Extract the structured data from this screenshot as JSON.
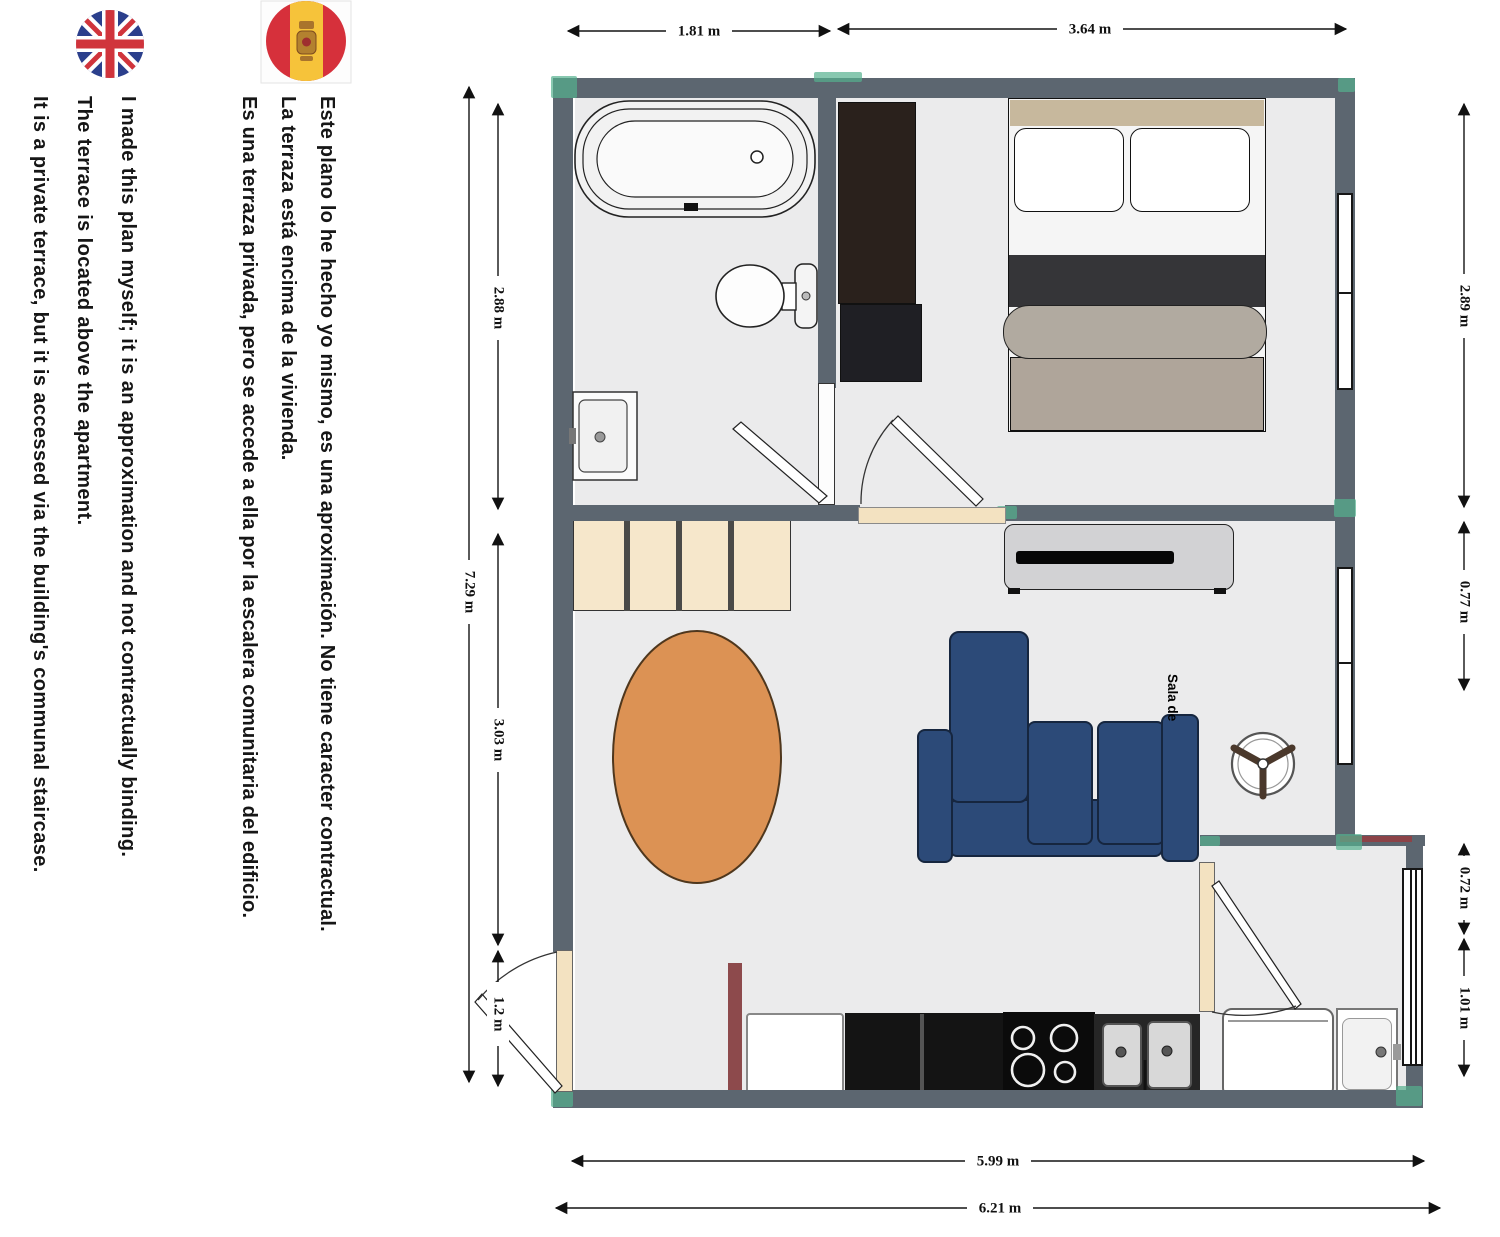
{
  "notes": {
    "english": [
      "I made this plan myself; it is an approximation and not contractually binding.",
      "The terrace is located above the apartment.",
      "It is a private terrace, but it is accessed via the building's communal staircase."
    ],
    "spanish": [
      "Este plano lo he hecho yo mismo, es una aproximación. No tiene caracter contractual.",
      "La terraza está encima de la vivienda.",
      "Es una terraza privada, pero se accede a ella por la escalera comunitaria del edificio."
    ]
  },
  "dimensions": {
    "top": [
      "1.81 m",
      "3.64 m"
    ],
    "left": {
      "outer": "7.29 m",
      "segments": [
        "2.88 m",
        "3.03 m",
        "1.2 m"
      ]
    },
    "right": [
      "2.89 m",
      "0.77 m",
      "0.72 m",
      "1.01 m"
    ],
    "bottom": [
      "5.99 m",
      "6.21 m"
    ]
  },
  "labels": {
    "living_room": "Sala de"
  },
  "colors": {
    "wall": "#5c6670",
    "floor": "#ebebec",
    "accent_teal": "#55b08f",
    "sofa_blue": "#2c4a78",
    "rug_orange": "#dc9254",
    "stairs_cream": "#f6e7cb",
    "door_cream": "#f3e2c1",
    "red_marker": "#8c4348"
  }
}
